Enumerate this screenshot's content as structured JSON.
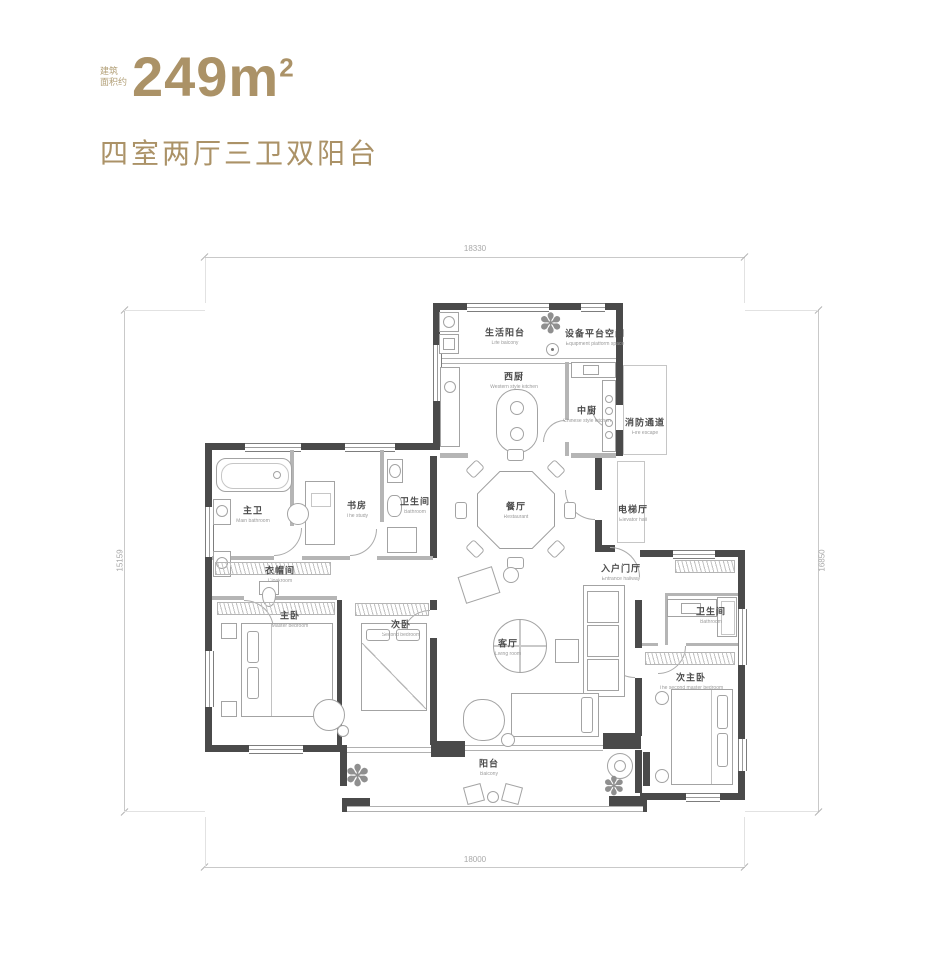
{
  "header": {
    "area_label_line1": "建筑",
    "area_label_line2": "面积约",
    "area_value": "249m",
    "area_exponent": "2",
    "subtitle": "四室两厅三卫双阳台",
    "accent_color": "#ab9267"
  },
  "dimensions": {
    "top": "18330",
    "bottom": "18000",
    "left": "15159",
    "right": "16850"
  },
  "icons": {
    "plant": "✽"
  },
  "rooms": {
    "life_balcony": {
      "cn": "生活阳台",
      "en": "Life balcony"
    },
    "equipment_platform": {
      "cn": "设备平台空间",
      "en": "Equipment platform space"
    },
    "west_kitchen": {
      "cn": "西厨",
      "en": "Western style kitchen"
    },
    "chinese_kitchen": {
      "cn": "中厨",
      "en": "Chinese style kitchen"
    },
    "fire_passage": {
      "cn": "消防通道",
      "en": "Fire escape"
    },
    "dining": {
      "cn": "餐厅",
      "en": "Restaurant"
    },
    "elevator_hall": {
      "cn": "电梯厅",
      "en": "Elevator hall"
    },
    "entrance": {
      "cn": "入户门厅",
      "en": "Entrance hallway"
    },
    "master_bath": {
      "cn": "主卫",
      "en": "Main bathroom"
    },
    "study": {
      "cn": "书房",
      "en": "The study"
    },
    "bathroom_mid": {
      "cn": "卫生间",
      "en": "Bathroom"
    },
    "cloakroom": {
      "cn": "衣帽间",
      "en": "Cloakroom"
    },
    "master_bedroom": {
      "cn": "主卧",
      "en": "Master bedroom"
    },
    "second_bedroom": {
      "cn": "次卧",
      "en": "Second bedroom"
    },
    "living": {
      "cn": "客厅",
      "en": "Living room"
    },
    "bathroom_right": {
      "cn": "卫生间",
      "en": "Bathroom"
    },
    "second_master": {
      "cn": "次主卧",
      "en": "The second master bedroom"
    },
    "balcony": {
      "cn": "阳台",
      "en": "Balcony"
    }
  }
}
